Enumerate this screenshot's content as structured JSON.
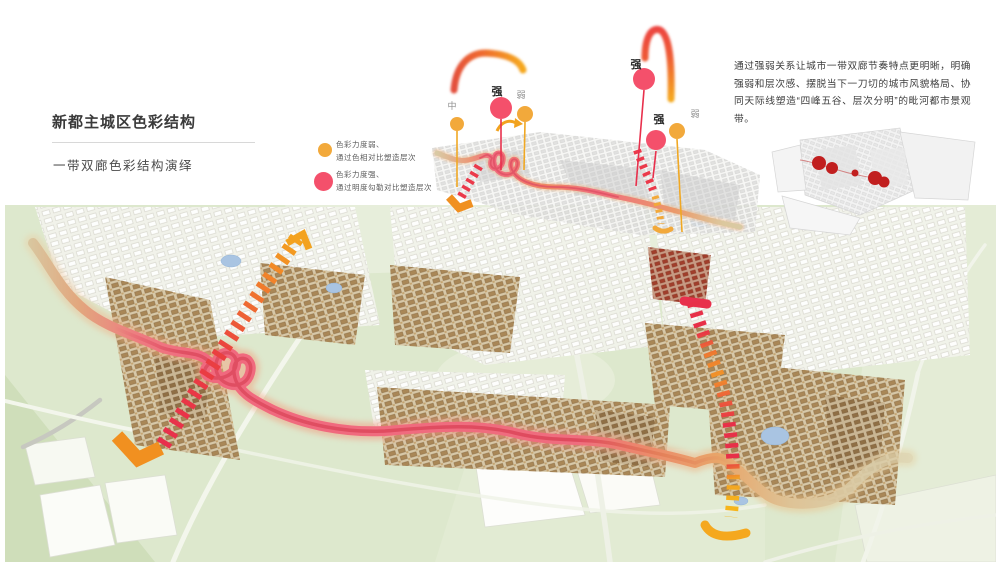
{
  "page": {
    "title": "新都主城区色彩结构",
    "subtitle": "一带双廊色彩结构演绎"
  },
  "legend": {
    "items": [
      {
        "color": "#F2A93B",
        "line1": "色彩力度弱、",
        "line2": "通过色相对比塑造层次"
      },
      {
        "color": "#F4506B",
        "line1": "色彩力度强、",
        "line2": "通过明度勾勒对比塑造层次"
      }
    ]
  },
  "description": {
    "text": "通过强弱关系让城市一带双廊节奏特点更明晰，明确强弱和层次感、摆脱当下一刀切的城市风貌格局、协同天际线塑造“四峰五谷、层次分明”的毗河都市景观带。"
  },
  "diagram": {
    "left_pins": [
      {
        "label": "中",
        "strength": "medium",
        "color": "#F2A93B"
      },
      {
        "label": "强",
        "strength": "strong",
        "color": "#F4506B"
      },
      {
        "label": "弱",
        "strength": "weak",
        "color": "#F2A93B"
      }
    ],
    "right_pins": [
      {
        "label": "强",
        "strength": "strong",
        "color": "#F4506B"
      },
      {
        "label": "强",
        "strength": "strong",
        "color": "#F4506B"
      },
      {
        "label": "弱",
        "strength": "weak",
        "color": "#F2A93B"
      }
    ]
  },
  "colors": {
    "strong_red": "#F4506B",
    "weak_yellow": "#F2A93B",
    "corridor_pink": "#EF6D7E",
    "map_green": "#DDE8CD"
  }
}
